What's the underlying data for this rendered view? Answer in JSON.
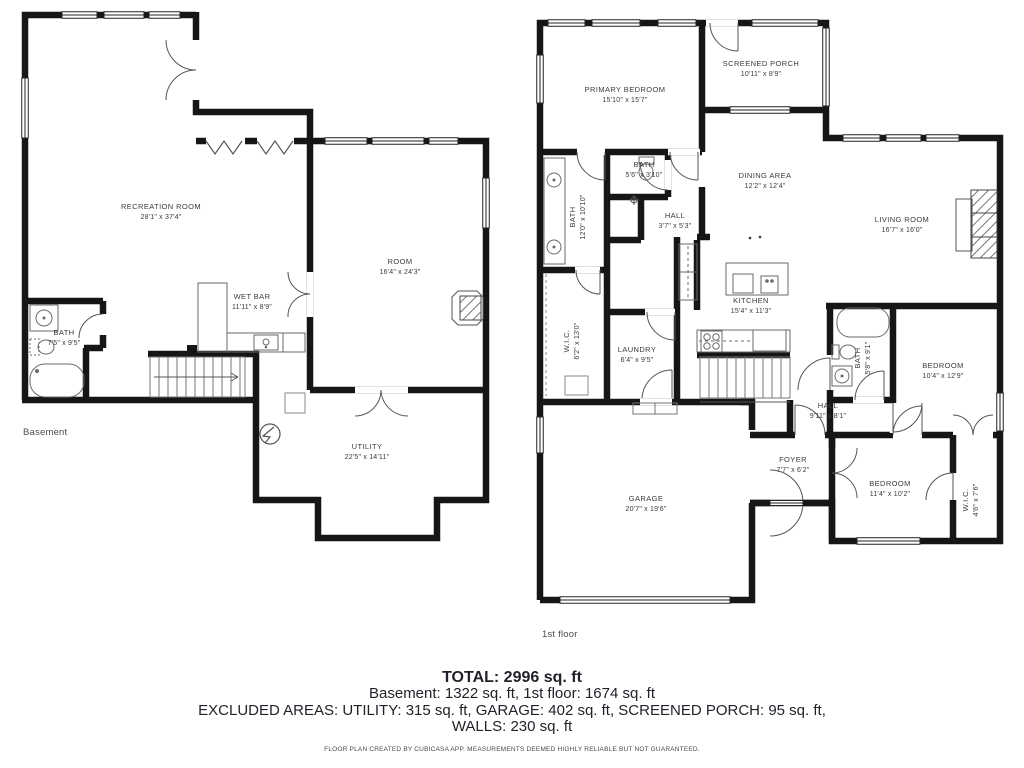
{
  "basement": {
    "floor_label": "Basement",
    "rooms": [
      {
        "name": "RECREATION ROOM",
        "dims": "28'1\" x 37'4\""
      },
      {
        "name": "ROOM",
        "dims": "16'4\" x 24'3\""
      },
      {
        "name": "WET BAR",
        "dims": "11'11\" x 8'9\""
      },
      {
        "name": "BATH",
        "dims": "7'5\" x 9'5\""
      },
      {
        "name": "UTILITY",
        "dims": "22'5\" x 14'11\""
      }
    ]
  },
  "first_floor": {
    "floor_label": "1st floor",
    "rooms": [
      {
        "name": "PRIMARY BEDROOM",
        "dims": "15'10\" x 15'7\""
      },
      {
        "name": "SCREENED PORCH",
        "dims": "10'11\" x 8'9\""
      },
      {
        "name": "BATH",
        "dims": "5'6\" x 3'10\""
      },
      {
        "name": "BATH",
        "dims": "12'0\" x 10'10\""
      },
      {
        "name": "HALL",
        "dims": "3'7\" x 5'3\""
      },
      {
        "name": "DINING AREA",
        "dims": "12'2\" x 12'4\""
      },
      {
        "name": "LIVING ROOM",
        "dims": "16'7\" x 16'0\""
      },
      {
        "name": "KITCHEN",
        "dims": "15'4\" x 11'3\""
      },
      {
        "name": "W.I.C.",
        "dims": "6'2\" x 13'0\""
      },
      {
        "name": "LAUNDRY",
        "dims": "6'4\" x 9'5\""
      },
      {
        "name": "BATH",
        "dims": "5'8\" x 9'1\""
      },
      {
        "name": "BEDROOM",
        "dims": "10'4\" x 12'9\""
      },
      {
        "name": "HALL",
        "dims": "9'11\" x 8'1\""
      },
      {
        "name": "FOYER",
        "dims": "7'7\" x 6'2\""
      },
      {
        "name": "BEDROOM",
        "dims": "11'4\" x 10'2\""
      },
      {
        "name": "W.I.C.",
        "dims": "4'6\" x 7'6\""
      },
      {
        "name": "GARAGE",
        "dims": "20'7\" x 19'6\""
      }
    ]
  },
  "summary": {
    "total": "TOTAL: 2996 sq. ft",
    "floors": "Basement: 1322 sq. ft, 1st floor: 1674 sq. ft",
    "excluded": "EXCLUDED AREAS: UTILITY: 315 sq. ft, GARAGE: 402 sq. ft, SCREENED PORCH: 95 sq. ft,",
    "walls": "WALLS: 230 sq. ft",
    "disclaimer": "FLOOR PLAN CREATED BY CUBICASA APP. MEASUREMENTS DEEMED HIGHLY RELIABLE BUT NOT GUARANTEED."
  },
  "colors": {
    "wall": "#161616",
    "text": "#3b3b3b",
    "fixture": "#6a6a6a"
  }
}
